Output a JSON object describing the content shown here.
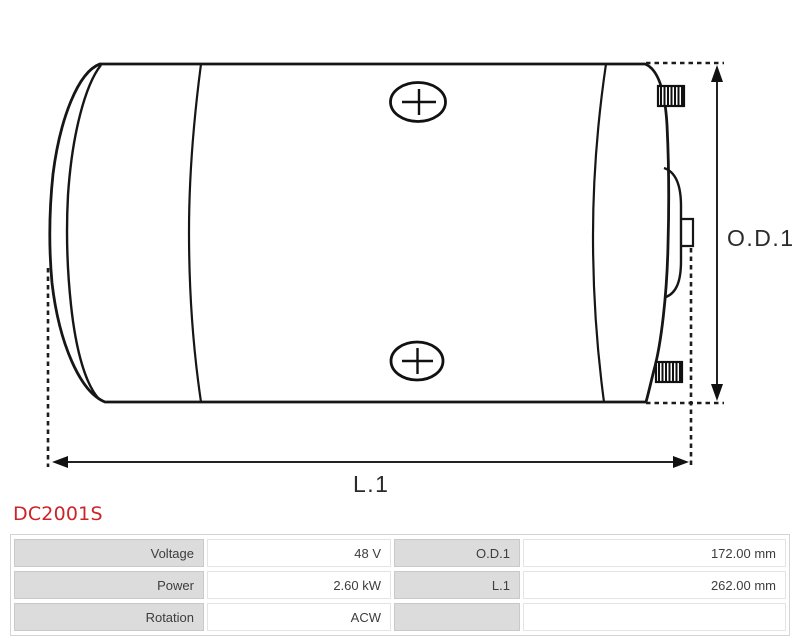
{
  "page": {
    "background": "#ffffff"
  },
  "product": {
    "code": "DC2001S",
    "code_color": "#cc2428"
  },
  "diagram": {
    "type": "technical-drawing-dc-motor-side-view",
    "line_color": "#1a1a1a",
    "od1_label": "O.D.1",
    "l1_label": "L.1"
  },
  "spec_table": {
    "label_bg": "#dcdcdc",
    "rows": [
      {
        "label_left": "Voltage",
        "value_left": "48 V",
        "label_right": "O.D.1",
        "value_right": "172.00 mm"
      },
      {
        "label_left": "Power",
        "value_left": "2.60 kW",
        "label_right": "L.1",
        "value_right": "262.00 mm"
      },
      {
        "label_left": "Rotation",
        "value_left": "ACW",
        "label_right": "",
        "value_right": ""
      }
    ]
  }
}
